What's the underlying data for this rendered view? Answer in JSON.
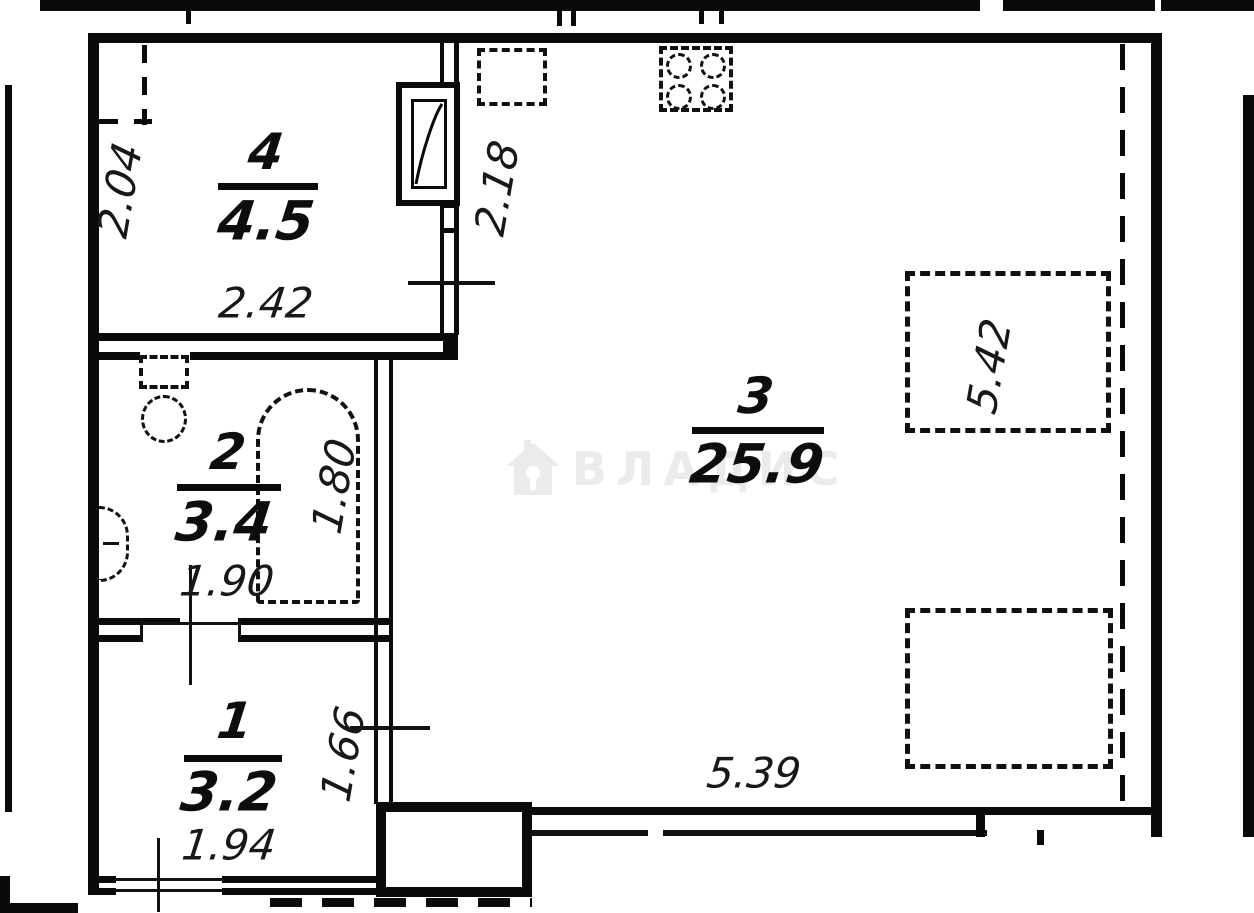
{
  "plan_title": "apartment-floor-plan",
  "rooms": [
    {
      "number": "1",
      "area": "3.2",
      "width_dim": "1.94",
      "depth_dim": "1.66"
    },
    {
      "number": "2",
      "area": "3.4",
      "width_dim": "1.90",
      "depth_dim": "1.80"
    },
    {
      "number": "3",
      "area": "25.9",
      "width_dim": "5.39",
      "depth_dim": "5.42",
      "wall_dim": "2.18"
    },
    {
      "number": "4",
      "area": "4.5",
      "width_dim": "2.42",
      "depth_dim": "2.04"
    }
  ],
  "watermark": {
    "text": "ВЛАДИС",
    "color": "#ebebeb"
  },
  "colors": {
    "wall": "#0a0a0a",
    "background": "#ffffff",
    "dimension_text": "#181818"
  },
  "icons": {
    "stove-icon": "css-dashed-square-with-4-burner-circles",
    "kitchen-sink-icon": "css-dashed-square",
    "toilet-icon": "css-dashed-tank-and-round-bowl",
    "washbasin-icon": "css-dashed-half-oval-on-wall",
    "shower-icon": "css-dashed-arch-topped-rect",
    "wardrobe-icon": "css-dashed-corner-lines",
    "furniture-icon": "css-dashed-rectangle",
    "electrical-panel-icon": "svg-rect-with-diagonal-curve",
    "watermark-house-icon": "svg-house-with-keyhole"
  }
}
